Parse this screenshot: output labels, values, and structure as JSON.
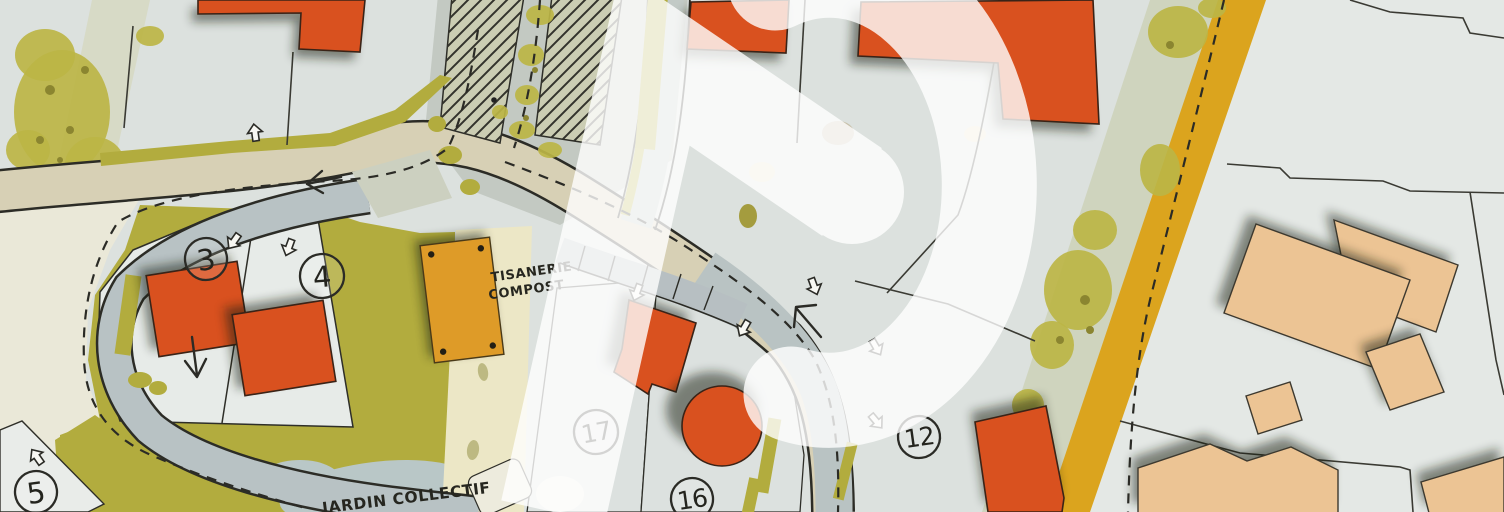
{
  "map": {
    "labels": {
      "tisanerie_1": "TISANERIE",
      "tisanerie_2": "COMPOST",
      "jardin": "JARDIN COLLECTIF"
    },
    "lots": [
      {
        "number": "3"
      },
      {
        "number": "4"
      },
      {
        "number": "5"
      },
      {
        "number": "17"
      },
      {
        "number": "16"
      },
      {
        "number": "12"
      }
    ],
    "palette": {
      "background_parcel": "#dce1de",
      "parcel_light": "#e7ebe8",
      "olive_green": "#b2ac3e",
      "road_tan": "#d7d0b5",
      "road_gray_blue": "#b8c2c4",
      "building_orange": "#d9511f",
      "building_peach": "#ecc494",
      "building_ochre": "#de9b28",
      "gold_path": "#dba41e",
      "pond_gray": "#b9c7c7",
      "cream": "#eae8d8",
      "ink": "#2b2b26",
      "watermark": "#ffffff"
    },
    "watermark": {
      "shape": "white P-logo with chevron",
      "opacity": 0.8
    }
  }
}
